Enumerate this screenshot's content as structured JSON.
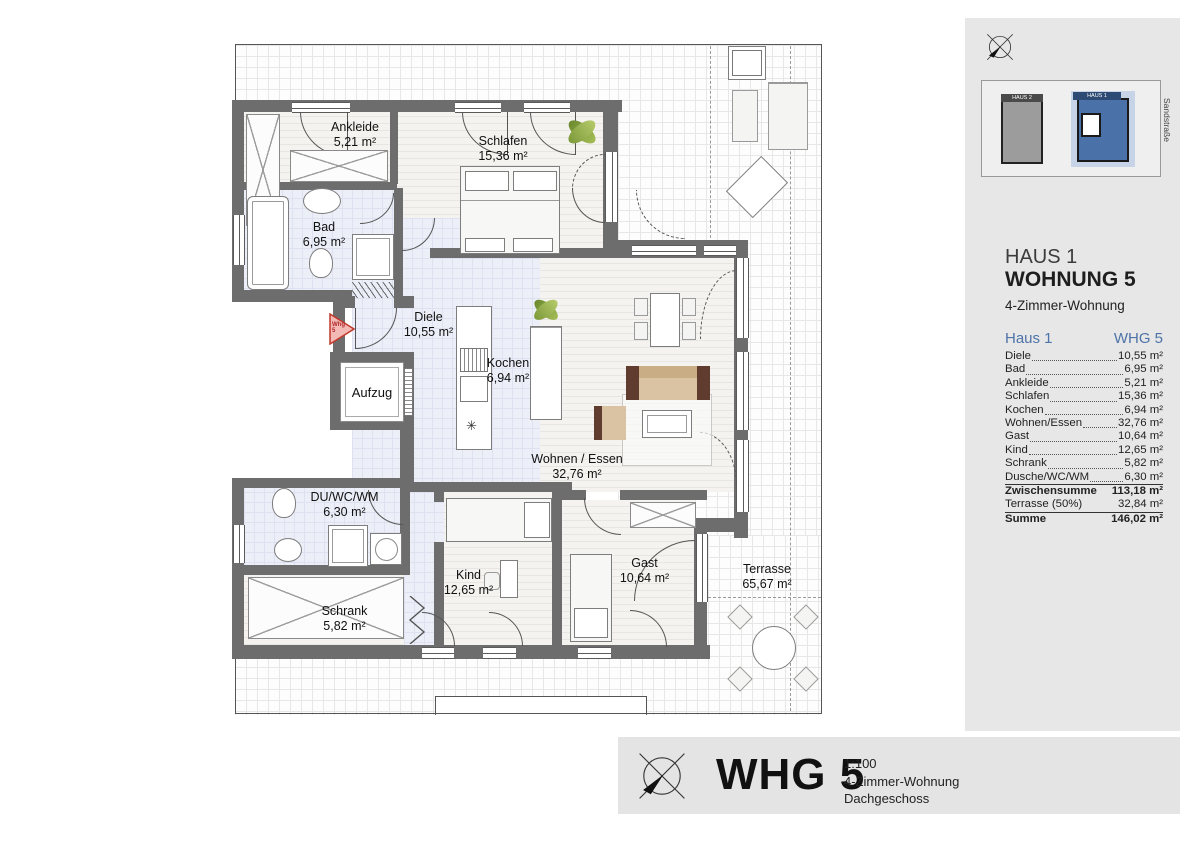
{
  "colors": {
    "accent_blue": "#4e73a8",
    "wall_gray": "#6d6d6d",
    "panel_gray": "#e7e7e7",
    "tile_floor": "#edeff8",
    "marker_red": "#c0392b",
    "building_blue": "#4a72a8",
    "building_gray": "#9c9c9c"
  },
  "plan": {
    "rooms": [
      {
        "name": "Ankleide",
        "area": "5,21 m²"
      },
      {
        "name": "Schlafen",
        "area": "15,36 m²"
      },
      {
        "name": "Bad",
        "area": "6,95 m²"
      },
      {
        "name": "Diele",
        "area": "10,55 m²"
      },
      {
        "name": "Kochen",
        "area": "6,94 m²"
      },
      {
        "name": "Wohnen / Essen",
        "area": "32,76 m²"
      },
      {
        "name": "DU/WC/WM",
        "area": "6,30 m²"
      },
      {
        "name": "Schrank",
        "area": "5,82 m²"
      },
      {
        "name": "Kind",
        "area": "12,65 m²"
      },
      {
        "name": "Gast",
        "area": "10,64 m²"
      },
      {
        "name": "Terrasse",
        "area": "65,67 m²"
      }
    ],
    "aufzug_label": "Aufzug",
    "marker": {
      "line1": "Whg",
      "line2": "5"
    },
    "kitchen_star": "✳"
  },
  "sidebar": {
    "minimap": {
      "haus2_label": "HAUS 2",
      "haus1_label": "HAUS 1",
      "street": "Sandstraße"
    },
    "title_house": "HAUS 1",
    "title_apartment": "WOHNUNG 5",
    "subtitle": "4-Zimmer-Wohnung",
    "table": {
      "header_left": "Haus 1",
      "header_right": "WHG 5",
      "rows": [
        {
          "label": "Diele",
          "value": "10,55 m²"
        },
        {
          "label": "Bad",
          "value": "6,95 m²"
        },
        {
          "label": "Ankleide",
          "value": "5,21 m²"
        },
        {
          "label": "Schlafen",
          "value": "15,36 m²"
        },
        {
          "label": "Kochen",
          "value": "6,94 m²"
        },
        {
          "label": "Wohnen/Essen",
          "value": "32,76 m²"
        },
        {
          "label": "Gast",
          "value": "10,64 m²"
        },
        {
          "label": "Kind",
          "value": "12,65 m²"
        },
        {
          "label": "Schrank",
          "value": "5,82 m²"
        },
        {
          "label": "Dusche/WC/WM",
          "value": "6,30 m²"
        }
      ],
      "subtotal": {
        "label": "Zwischensumme",
        "value": "113,18 m²"
      },
      "terrace": {
        "label": "Terrasse (50%)",
        "value": "32,84 m²"
      },
      "total": {
        "label": "Summe",
        "value": "146,02 m²"
      }
    }
  },
  "titleblock": {
    "title": "WHG 5",
    "scale": "1:100",
    "line2": "4-Zimmer-Wohnung",
    "line3": "Dachgeschoss"
  }
}
